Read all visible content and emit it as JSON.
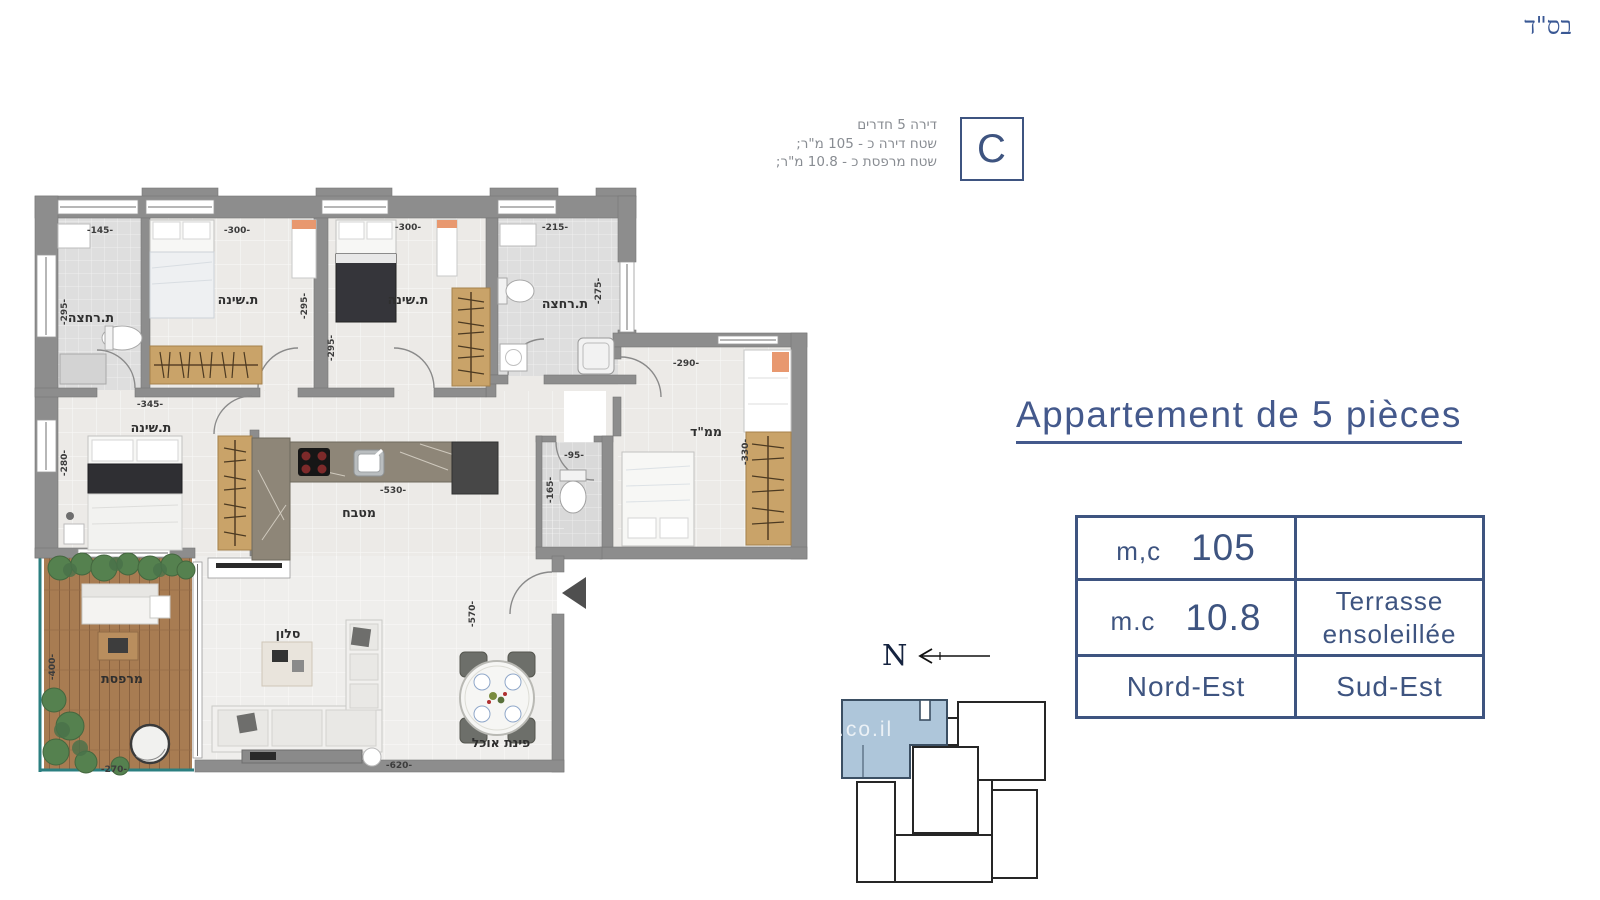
{
  "header": {
    "bsd": "בס\"ד"
  },
  "info": {
    "line1": "דירה 5 חדרים",
    "line2": "שטח דירה כ - 105 מ\"ר;",
    "line3": "שטח מרפסת כ - 10.8 מ\"ר;",
    "unit_letter": "C"
  },
  "title": {
    "text": "Appartement de 5 pièces"
  },
  "table": {
    "r1c1_label": "m,c",
    "r1c1_value": "105",
    "r1c2": "",
    "r2c1_label": "m.c",
    "r2c1_value": "10.8",
    "r2c2_line1": "Terrasse",
    "r2c2_line2": "ensoleillée",
    "r3c1": "Nord-Est",
    "r3c2": "Sud-Est"
  },
  "compass": {
    "north_letter": "N"
  },
  "watermark": ".co.il",
  "plan": {
    "rooms": {
      "bath1": "ת.רחצה",
      "bed2": "ת.שינה",
      "bed3": "ת.שינה",
      "bath2": "ת.רחצה",
      "master": "ת.שינה",
      "kitchen": "מטבח",
      "mamad": "ממ\"ד",
      "living": "סלון",
      "dining": "פינת אוכל",
      "balcony": "מרפסת"
    },
    "dims": {
      "bath1_w": "-145-",
      "bath1_h": "-295-",
      "bed2_w": "-300-",
      "bed2_h": "-295-",
      "bed3_w": "-300-",
      "bed3_h": "-295-",
      "bath2_w": "-215-",
      "bath2_h": "-275-",
      "master_w": "-345-",
      "master_h": "-280-",
      "kitchen_w": "-530-",
      "wc_w": "-95-",
      "wc_h": "-165-",
      "mamad_w": "-290-",
      "mamad_h": "-330-",
      "living_h": "-570-",
      "living_w": "-620-",
      "balcony_h": "-400-",
      "balcony_w": "-270-"
    }
  },
  "colors": {
    "navy": "#3e5480",
    "wall_gray": "#8d8d8d",
    "site_highlight": "#aec6da",
    "wood": "#c9a369",
    "deck": "#a87c52",
    "railing_teal": "#2b7f80"
  }
}
